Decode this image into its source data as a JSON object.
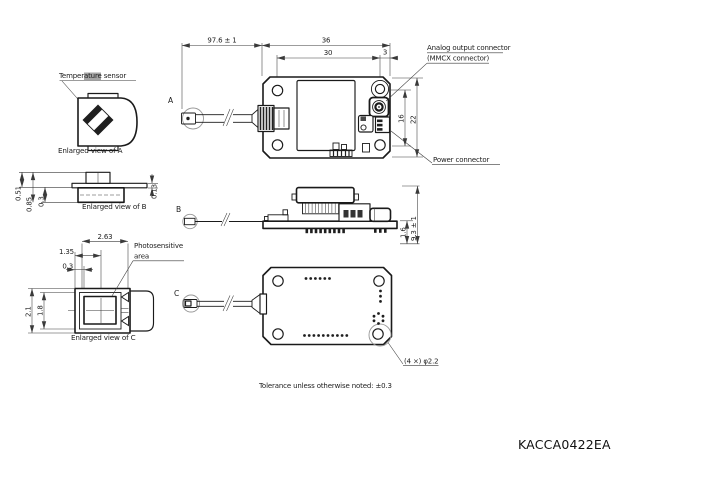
{
  "title": {
    "part_number": "KACCA0422EA"
  },
  "notes": {
    "tolerance": "Tolerance unless otherwise noted: ±0.3"
  },
  "enlarged_a": {
    "caption": "Enlarged view of A",
    "callout": "Temperature sensor"
  },
  "enlarged_b": {
    "caption": "Enlarged view of B",
    "dim_top": "0.51",
    "dim_total": "0.85",
    "dim_inner": "0.3",
    "dim_flange": "0.13"
  },
  "enlarged_c": {
    "caption": "Enlarged view of C",
    "callout_line1": "Photosensitive",
    "callout_line2": "area",
    "dim_width": "2.63",
    "dim_half": "1.35",
    "dim_offset": "0.3",
    "dim_height": "2.1",
    "dim_window": "1.8"
  },
  "top_view": {
    "marker": "A",
    "dim_cable": "97.6 ± 1",
    "dim_width": "36",
    "dim_holes": "30",
    "dim_edge": "3",
    "dim_conn_pitch": "16",
    "dim_height": "22",
    "callout_analog_line1": "Analog output connector",
    "callout_analog_line2": "(MMCX connector)",
    "callout_power": "Power connector"
  },
  "side_view": {
    "marker": "B",
    "dim_thickness": "1.6",
    "dim_height": "9.3 ± 1"
  },
  "bottom_view": {
    "marker": "C",
    "callout_holes": "(4 ×) φ2.2"
  }
}
